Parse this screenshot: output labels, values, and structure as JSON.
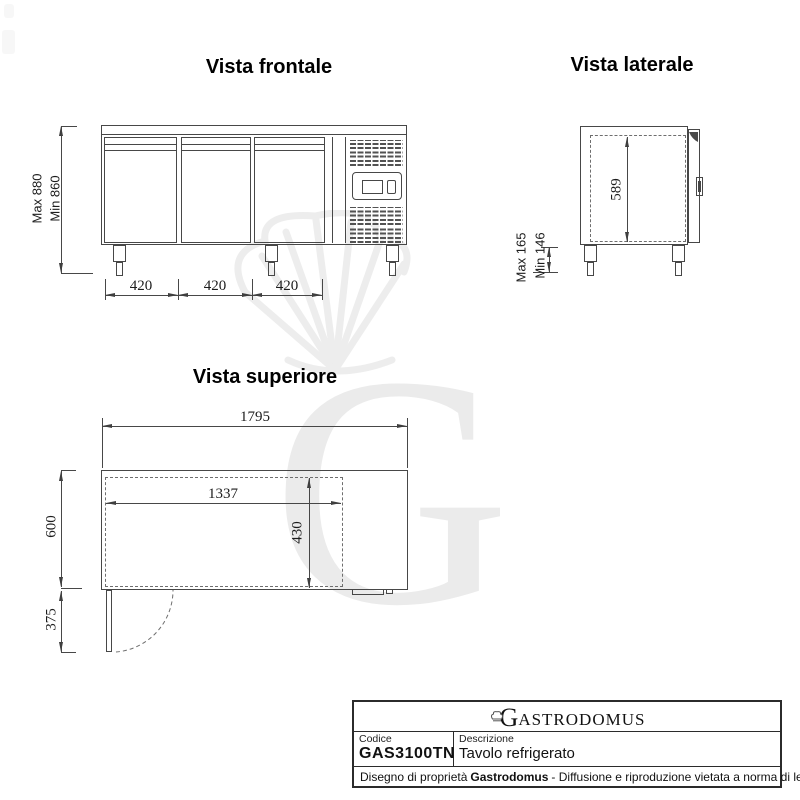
{
  "front": {
    "title": "Vista frontale",
    "height_max": "Max 880",
    "height_min": "Min 860",
    "door_widths": [
      "420",
      "420",
      "420"
    ]
  },
  "side": {
    "title": "Vista laterale",
    "inner_height": "589",
    "leg_max": "Max 165",
    "leg_min": "Min 146"
  },
  "top": {
    "title": "Vista superiore",
    "total_width": "1795",
    "inner_width": "1337",
    "inner_depth": "430",
    "depth": "600",
    "door_swing": "375"
  },
  "title_block": {
    "logo_initial": "G",
    "logo_rest": "ASTRODOMUS",
    "code_label": "Codice",
    "code_value": "GAS3100TN",
    "description_label": "Descrizione",
    "description_value": "Tavolo refrigerato",
    "footer_prefix": "Disegno di proprietà",
    "footer_brand": "Gastrodomus",
    "footer_suffix": "- Diffusione e riproduzione vietata a norma di legge."
  },
  "watermark": {
    "letter": "G"
  },
  "colors": {
    "line": "#474747",
    "text": "#1c1c1c",
    "watermark": "#ebebeb"
  }
}
